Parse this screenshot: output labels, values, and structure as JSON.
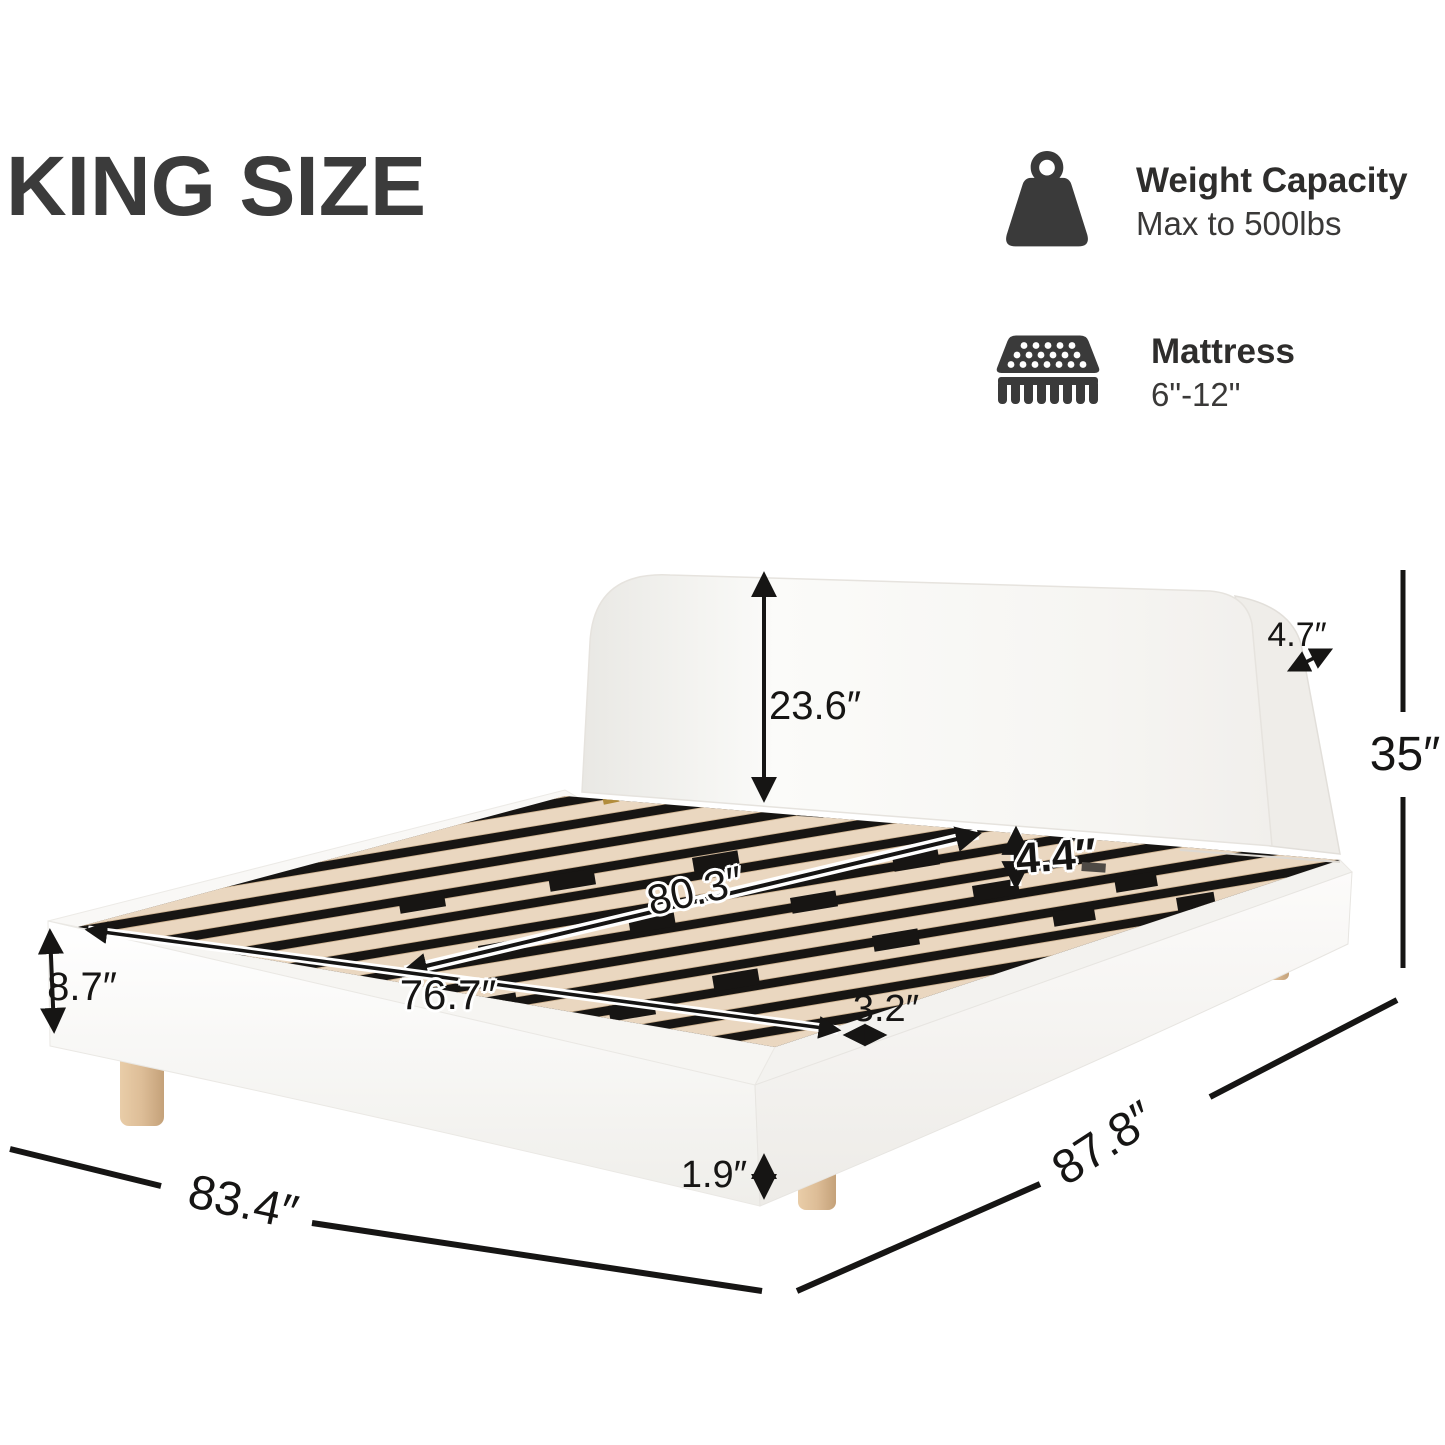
{
  "title": "KING SIZE",
  "features": [
    {
      "name": "weight-capacity",
      "icon": "kettlebell-weight-icon",
      "title": "Weight Capacity",
      "subtitle": "Max to 500lbs"
    },
    {
      "name": "mattress",
      "icon": "mattress-icon",
      "title": "Mattress",
      "subtitle": "6\"-12\""
    }
  ],
  "dimensions": {
    "headboard_height": "23.6″",
    "headboard_thickness": "4.7″",
    "total_height": "35″",
    "slat_length": "80.3″",
    "slat_clearance": "4.4″",
    "side_rail_height": "8.7″",
    "slat_width": "76.7″",
    "slat_side_gap": "3.2″",
    "leg_height": "1.9″",
    "overall_width": "83.4″",
    "overall_length": "87.8″"
  },
  "colors": {
    "ink": "#161514",
    "title_gray": "#3b3b3b",
    "icon_gray": "#3a3a3a",
    "bed_white": "#f7f6f3",
    "interior_black": "#171513",
    "slat_wood": "#ead7c0",
    "leg_wood": "#ddbd97"
  }
}
